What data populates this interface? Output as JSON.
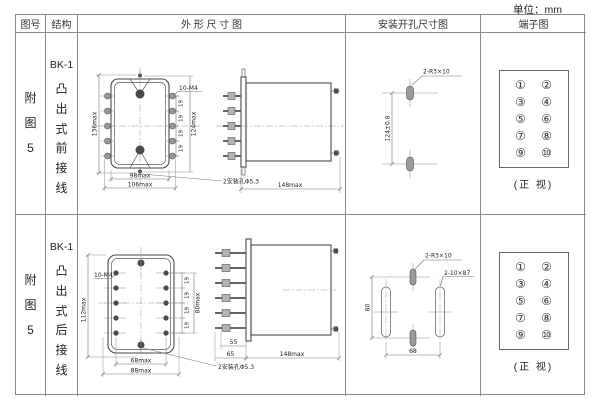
{
  "unit_label": "单位：mm",
  "headers": {
    "figure": "图号",
    "structure": "结构",
    "outline": "外 形 尺 寸 图",
    "mounting": "安装开孔尺寸图",
    "terminal": "端子图"
  },
  "rows": [
    {
      "figure_no": "附图5",
      "model": "BK-1",
      "wiring": "凸出式前接线",
      "front": {
        "thread": "10-M4",
        "height": "136max",
        "terminal_span": "124max",
        "pitch": "19",
        "width": "98max",
        "width_overall": "106max",
        "holes": "2安装孔Φ5.3"
      },
      "side": {
        "depth": "148max"
      },
      "cutout": {
        "slots": "2-R3×10",
        "spacing": "124±0.8"
      },
      "terminal": {
        "pins": [
          "①",
          "②",
          "③",
          "④",
          "⑤",
          "⑥",
          "⑦",
          "⑧",
          "⑨",
          "⑩"
        ],
        "caption": "(正 视)"
      }
    },
    {
      "figure_no": "附图5",
      "model": "BK-1",
      "wiring": "凸出式后接线",
      "front": {
        "thread": "10-M4",
        "height": "112max",
        "terminal_span": "80max",
        "pitch": "19",
        "width": "68max",
        "width_overall": "88max",
        "holes": "2安装孔Φ5.3"
      },
      "side": {
        "stud": "55",
        "base": "65",
        "depth": "148max"
      },
      "cutout": {
        "small_slots": "2-R3×10",
        "long_slots": "2-10×87",
        "spacing_v": "80",
        "spacing_h": "68"
      },
      "terminal": {
        "pins": [
          "①",
          "②",
          "③",
          "④",
          "⑤",
          "⑥",
          "⑦",
          "⑧",
          "⑨",
          "⑩"
        ],
        "caption": "(正 视)"
      }
    }
  ]
}
